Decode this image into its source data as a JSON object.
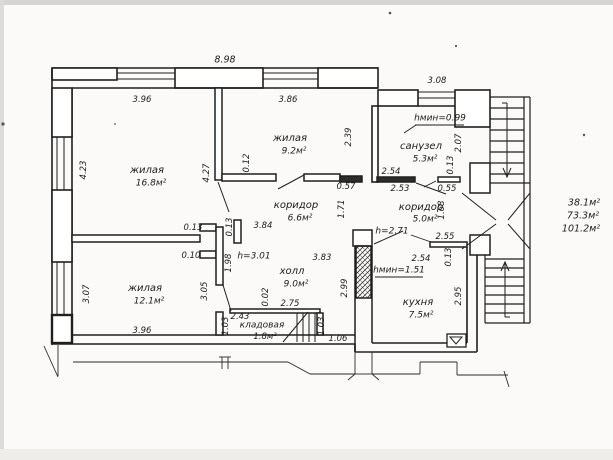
{
  "summary": {
    "living_total": "38.1м²",
    "usable_total": "73.3м²",
    "overall_total": "101.2м²"
  },
  "rooms": {
    "living_168": {
      "name": "жилая",
      "area": "16.8м²"
    },
    "living_92": {
      "name": "жилая",
      "area": "9.2м²"
    },
    "living_121": {
      "name": "жилая",
      "area": "12.1м²"
    },
    "corridor_66": {
      "name": "коридор",
      "area": "6.6м²"
    },
    "corridor_50": {
      "name": "коридор",
      "area": "5.0м²"
    },
    "bathroom": {
      "name": "санузел",
      "area": "5.3м²"
    },
    "hall": {
      "name": "холл",
      "area": "9.0м²"
    },
    "kitchen": {
      "name": "кухня",
      "area": "7.5м²"
    },
    "storage": {
      "name": "кладовая",
      "area": "1.8м²"
    }
  },
  "heights": {
    "h301": "h=3.01",
    "h271": "h=2.71",
    "hmin099": "hмин=0.99",
    "hmin151": "hмин=1.51"
  },
  "dims": {
    "d898": "8.98",
    "d396t": "3.96",
    "d386": "3.86",
    "d308": "3.08",
    "d423": "4.23",
    "d427": "4.27",
    "d012": "0.12",
    "d239": "2.39",
    "d207": "2.07",
    "d013sa": "0.13",
    "d254sa": "2.54",
    "d253": "2.53",
    "d057": "0.57",
    "d055": "0.55",
    "d171": "1.71",
    "d168": "1.68",
    "d384": "3.84",
    "d013j1": "0.13",
    "d013j2": "0.13",
    "d010": "0.10",
    "d198": "1.98",
    "d383": "3.83",
    "d255": "2.55",
    "d254k": "2.54",
    "d013k": "0.13",
    "d307": "3.07",
    "d305": "3.05",
    "d299": "2.99",
    "d295": "2.95",
    "d396b": "3.96",
    "d243": "2.43",
    "d103l": "1.03",
    "d002": "0.02",
    "d275": "2.75",
    "d103r": "1.03",
    "d106": "1.06"
  }
}
